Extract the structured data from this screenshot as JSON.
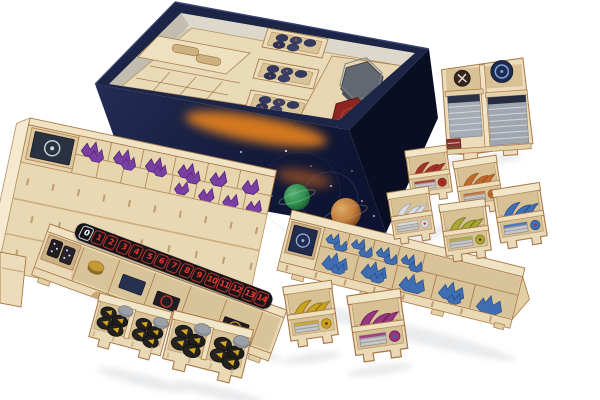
{
  "scene": {
    "subject": "product photo of a laser-cut wooden board game box insert organizer with trays of miniatures, tokens and sleeved cards",
    "background_color": "#ffffff"
  },
  "score_track": {
    "numbers": [
      "0",
      "1",
      "2",
      "3",
      "4",
      "5",
      "6",
      "7",
      "8",
      "9",
      "10",
      "11",
      "12",
      "13",
      "14"
    ],
    "zero_color": "#ffffff",
    "number_color": "#e8392b",
    "strip_color": "#17141a"
  },
  "palette": {
    "wood_face": "#e9d9b6",
    "wood_light": "#f2e6c8",
    "wood_dark": "#d9c196",
    "wood_edge": "#a87848",
    "box_navy": "#1b2344",
    "box_navy_dark": "#0c1126",
    "nebula_orange": "#e8821e",
    "planet_green": "#2f8f4c",
    "planet_orange": "#c07a3a",
    "mini_purple": "#7a3fa3",
    "mini_blue": "#3e6db2",
    "card_stack_gray": "#a8adb5",
    "token_black": "#23211e",
    "token_yellow": "#d9a71e",
    "token_magenta": "#98357f",
    "token_red": "#a63227",
    "token_orange": "#c06a2e",
    "token_white": "#d8dbdf",
    "token_olive": "#a8a832",
    "token_blue": "#3f6fb5",
    "hex_tile_red": "#8d2522",
    "hex_tile_gray": "#62686f"
  },
  "components": {
    "game_box": "open-game-box-with-space-artwork",
    "box_interior": "insert-trays-with-token-stacks-and-hex-tiles",
    "card_holder": "card-tray-with-sleeved-card-stacks",
    "miniature_trays": [
      "purple-miniatures-tray",
      "blue-miniatures-tray"
    ],
    "faction_token_trays": [
      "red",
      "orange",
      "white",
      "olive",
      "blue",
      "yellow",
      "magenta"
    ],
    "command_token_trays": [
      "black-yellow-tokens-1",
      "black-yellow-tokens-2"
    ],
    "score_track_tray": "tray-with-0-14-score-track"
  }
}
